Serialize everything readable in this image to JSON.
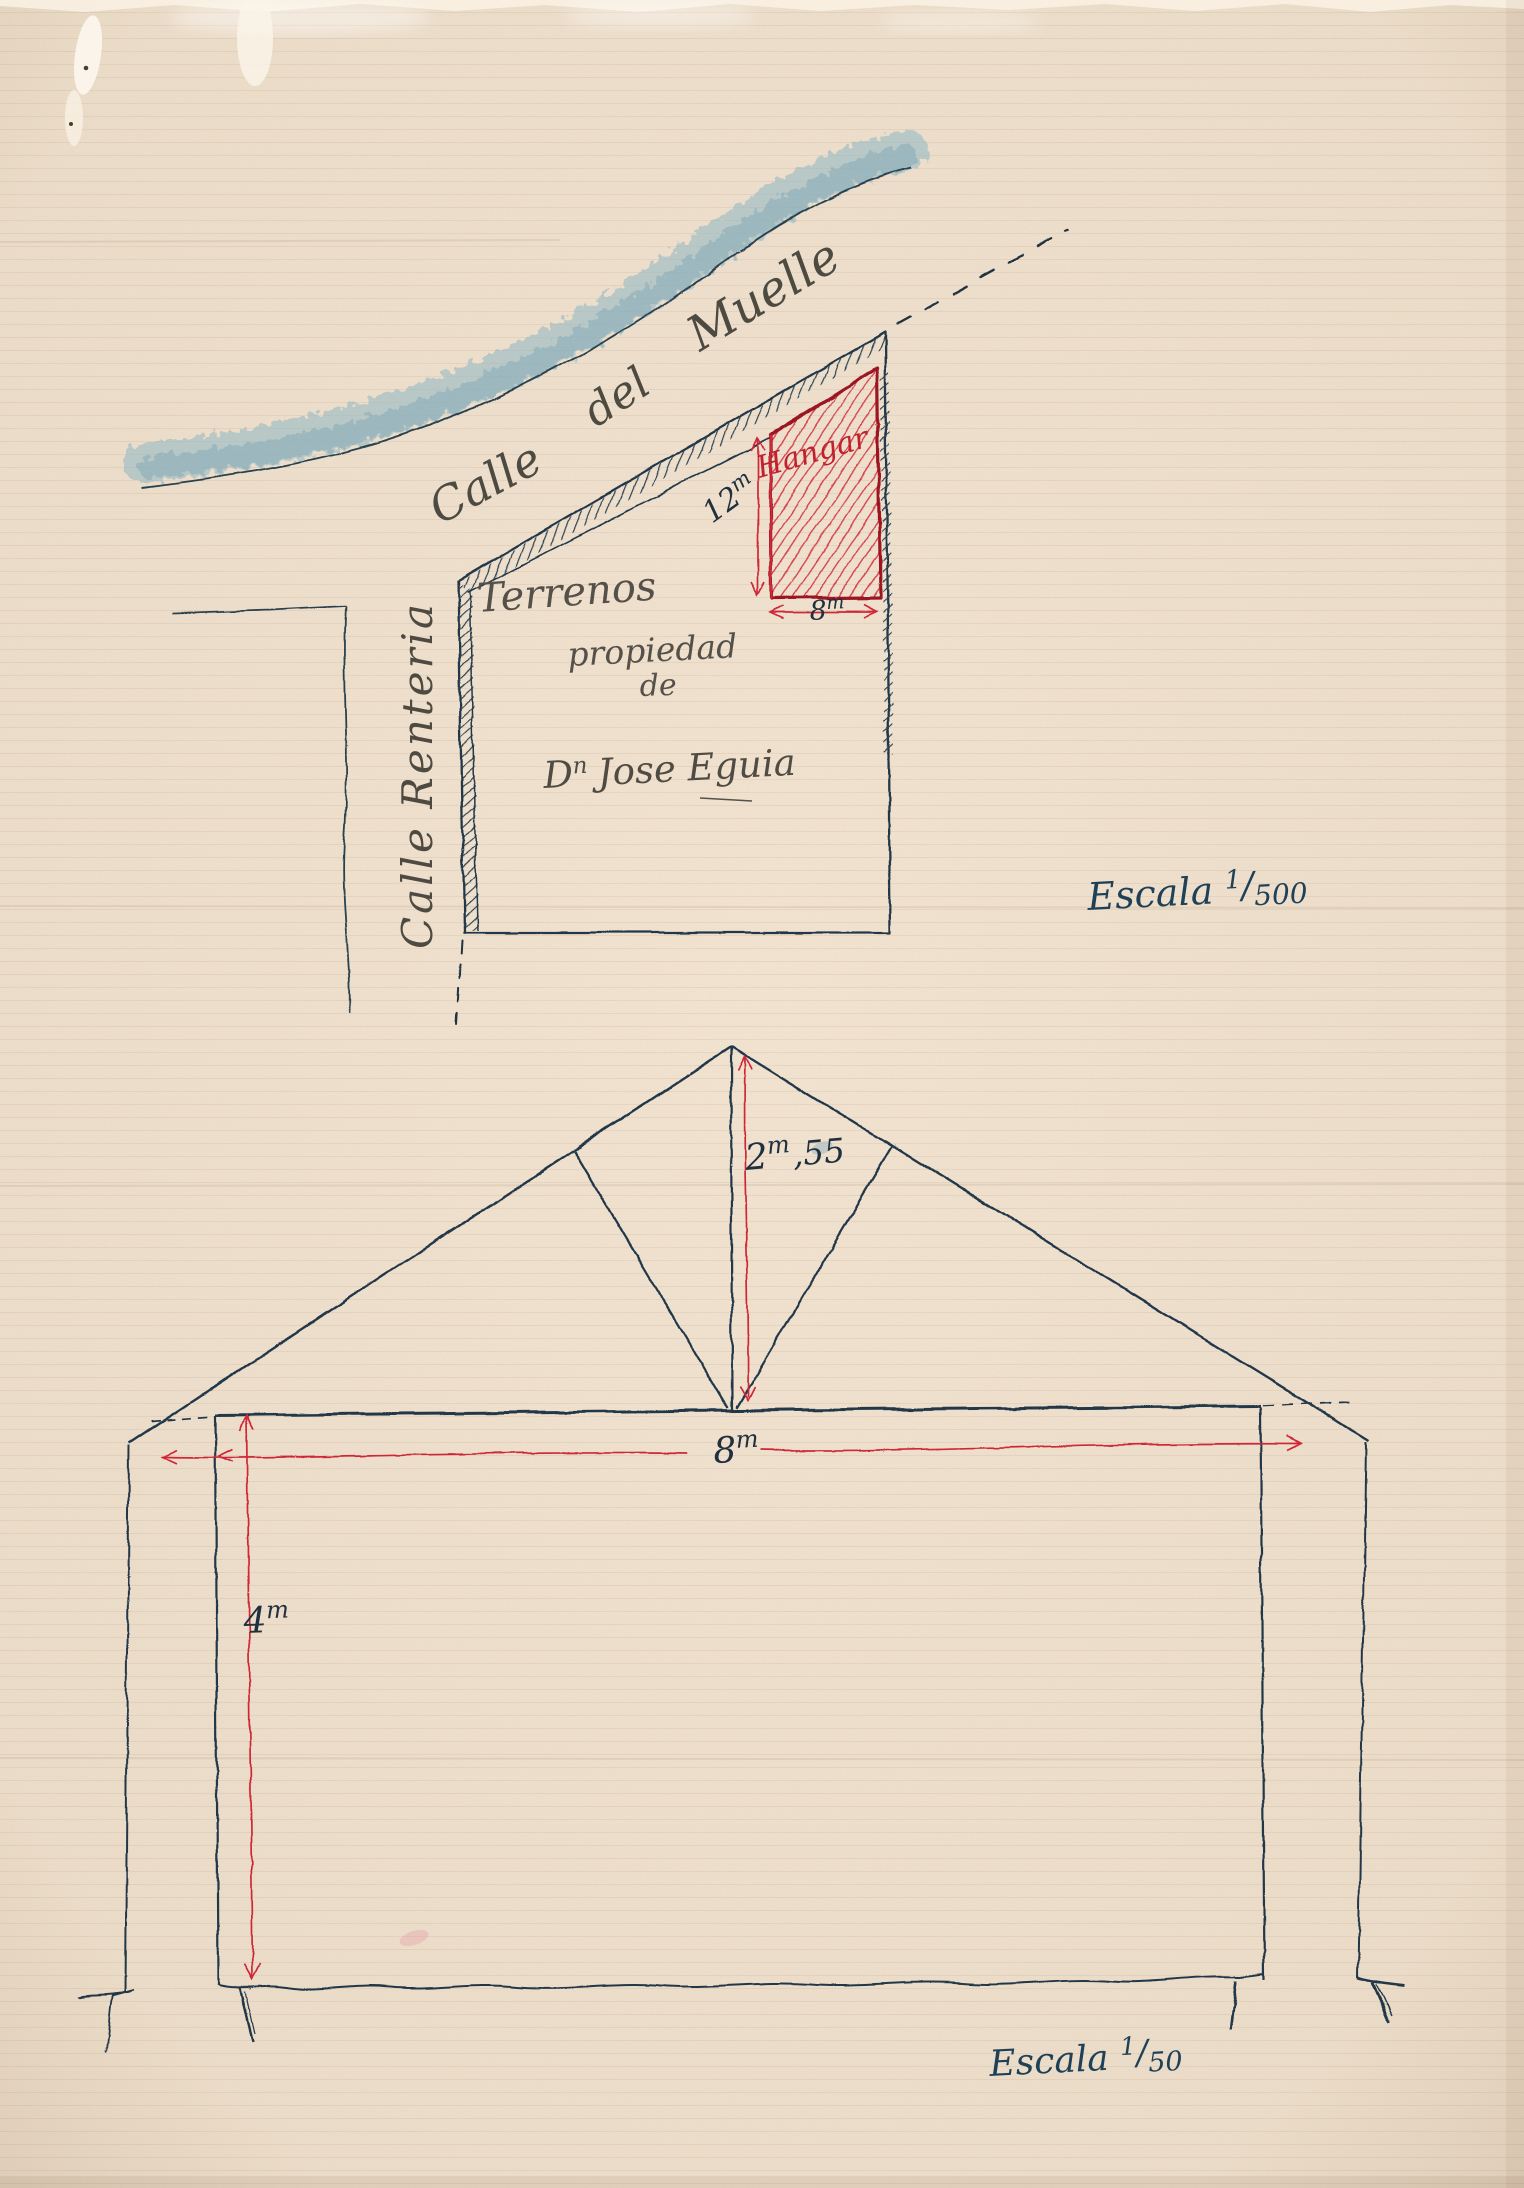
{
  "site_plan": {
    "street_muelle": {
      "word1": "Calle",
      "word2": "del",
      "word3": "Muelle"
    },
    "street_renteria": "Calle Renteria",
    "terrain": {
      "line1": "Terrenos",
      "line2": "propiedad",
      "line3": "de"
    },
    "owner": {
      "initial": "D",
      "superscript": "n",
      "name": "Jose Eguia"
    },
    "hangar": "Hangar",
    "dim_depth": {
      "value": "12",
      "unit": "m"
    },
    "dim_frontage": {
      "value": "8",
      "unit": "m"
    },
    "scale": {
      "word": "Escala",
      "numerator": "1",
      "denominator": "500"
    }
  },
  "section": {
    "dim_ridge_height": {
      "value": "2",
      "unit": "m",
      "decimals": ",55"
    },
    "dim_span": {
      "value": "8",
      "unit": "m"
    },
    "dim_wall_height": {
      "value": "4",
      "unit": "m"
    },
    "scale": {
      "word": "Escala",
      "numerator": "1",
      "denominator": "50"
    }
  },
  "colors": {
    "paper": "#f2e4d1",
    "ink": "#24394a",
    "pencil": "#4e4a41",
    "red": "#cf2837",
    "dark_red": "#9b1220",
    "blue_crayon": "#85aebb",
    "scale_ink": "#1f4158"
  }
}
